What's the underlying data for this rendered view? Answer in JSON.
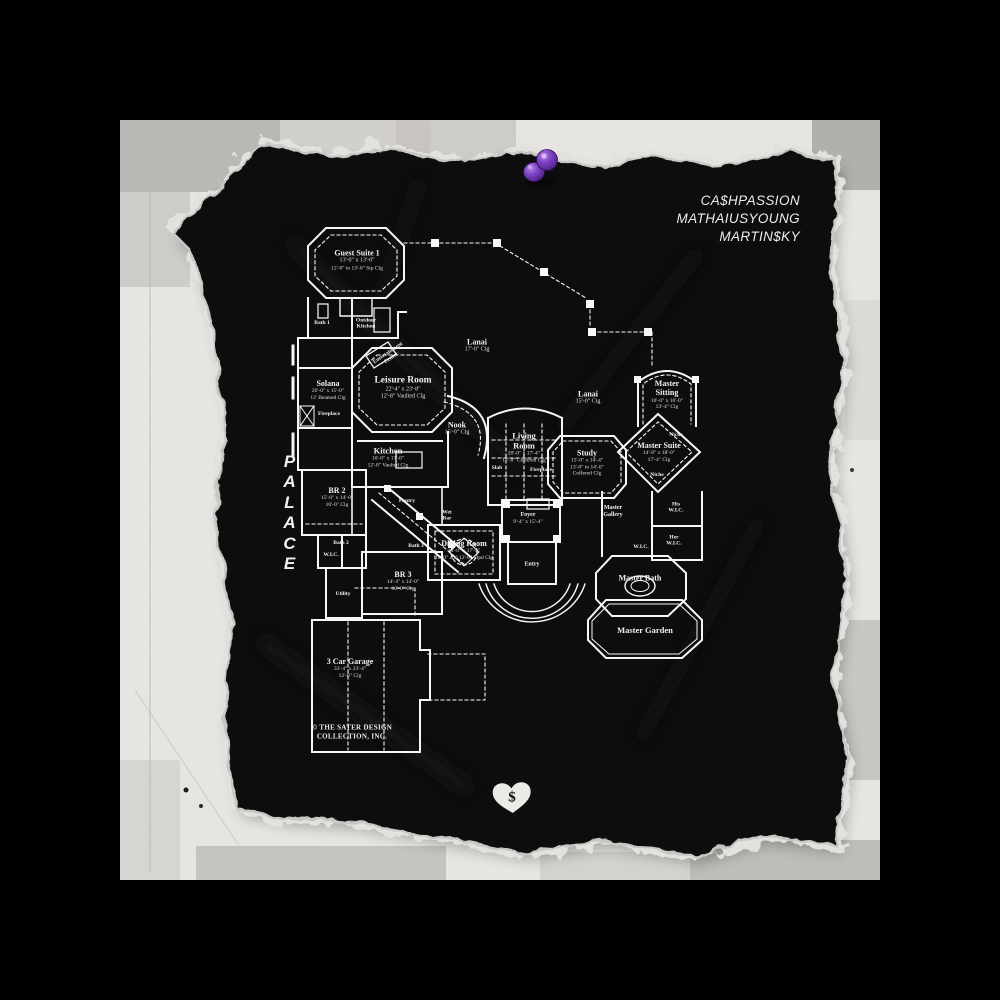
{
  "album": {
    "artists": [
      "CA$HPASSION",
      "MATHAIUSYOUNG",
      "MARTIN$KY"
    ],
    "title_vertical": "PALACE",
    "heart_symbol": "$"
  },
  "colors": {
    "frame_background": "#000000",
    "paper_white": "#e8e6e2",
    "paper_black": "#0b0b0a",
    "plan_line": "#f7f7f7",
    "pin_purple": "#7b3fc0"
  },
  "plan": {
    "copyright": {
      "line1": "© THE SATER DESIGN",
      "line2": "COLLECTION, INC."
    },
    "rooms": {
      "guest_suite": {
        "name": "Guest Suite 1",
        "l1": "13'-0\" x 13'-0\"",
        "l2": "12'-0\" to 13'-0\" Stp Clg"
      },
      "bath1": {
        "name": "Bath 1"
      },
      "outdoor_kitchen": {
        "name": "Outdoor",
        "l1": "Kitchen"
      },
      "solana": {
        "name": "Solana",
        "l1": "20'-0\" x 15'-0\"",
        "l2": "12' Beamed Clg"
      },
      "fireplace1": {
        "name": "Fireplace"
      },
      "ent_center": {
        "name": "Entertainment",
        "l1": "Center"
      },
      "leisure": {
        "name": "Leisure Room",
        "l1": "22'-4\" x 23'-8\"",
        "l2": "12'-8\" Vaulted Clg"
      },
      "lanai_upper": {
        "name": "Lanai",
        "l1": "17'-0\" Clg"
      },
      "lanai_right": {
        "name": "Lanai",
        "l1": "15'-0\" Clg"
      },
      "nook": {
        "name": "Nook",
        "l1": "15'-0\" Clg"
      },
      "kitchen": {
        "name": "Kitchen",
        "l1": "16'-0\" x 17'-0\"",
        "l2": "12'-8\" Vaulted Clg"
      },
      "living": {
        "name": "Living Room",
        "l1": "20'-0\" x 17'-4\"",
        "l2": "17'-8\" Coffered Clg"
      },
      "slab": {
        "name": "Slab"
      },
      "fireplace2": {
        "name": "Fireplace"
      },
      "study": {
        "name": "Study",
        "l1": "15'-0\" x 14'-4\"",
        "l2": "13'-0\" to 14'-0\"",
        "l3": "Coffered Clg"
      },
      "master_sitting": {
        "name": "Master Sitting",
        "l1": "10'-0\" x 10'-0\"",
        "l2": "13'-4\" Clg"
      },
      "master_suite": {
        "name": "Master Suite",
        "l1": "14'-8\" x 18'-0\"",
        "l2": "17'-4\" Clg"
      },
      "niche1": {
        "name": "Niche"
      },
      "niche2": {
        "name": "Niche"
      },
      "his_wic": {
        "name": "His",
        "l1": "W.I.C."
      },
      "her_wic": {
        "name": "Her",
        "l1": "W.I.C."
      },
      "master_gallery": {
        "name": "Master",
        "l1": "Gallery"
      },
      "wic_master": {
        "name": "W.I.C."
      },
      "br2": {
        "name": "BR 2",
        "l1": "15'-0\" x 14'-0\"",
        "l2": "10'-0\" Clg"
      },
      "pantry": {
        "name": "Pantry"
      },
      "wet_bar": {
        "name": "Wet",
        "l1": "Bar"
      },
      "bath2": {
        "name": "Bath 2"
      },
      "wic_small": {
        "name": "W.I.C."
      },
      "bath3": {
        "name": "Bath 3"
      },
      "dining": {
        "name": "Dining Room",
        "l1": "14'-0\" x 17'-4\"",
        "l2": "10'-0\" and 12'-0\" Stpd Clg"
      },
      "foyer": {
        "name": "Foyer",
        "l1": "9'-4\" x 15'-4\""
      },
      "entry": {
        "name": "Entry"
      },
      "br3": {
        "name": "BR 3",
        "l1": "14'-4\" x 14'-0\"",
        "l2": "10'-0\" Clg"
      },
      "utility": {
        "name": "Utility"
      },
      "garage": {
        "name": "3 Car Garage",
        "l1": "33'-4\" x 23'-4\"",
        "l2": "12'-0\" Clg"
      },
      "master_bath": {
        "name": "Master Bath"
      },
      "master_garden": {
        "name": "Master Garden"
      }
    }
  }
}
